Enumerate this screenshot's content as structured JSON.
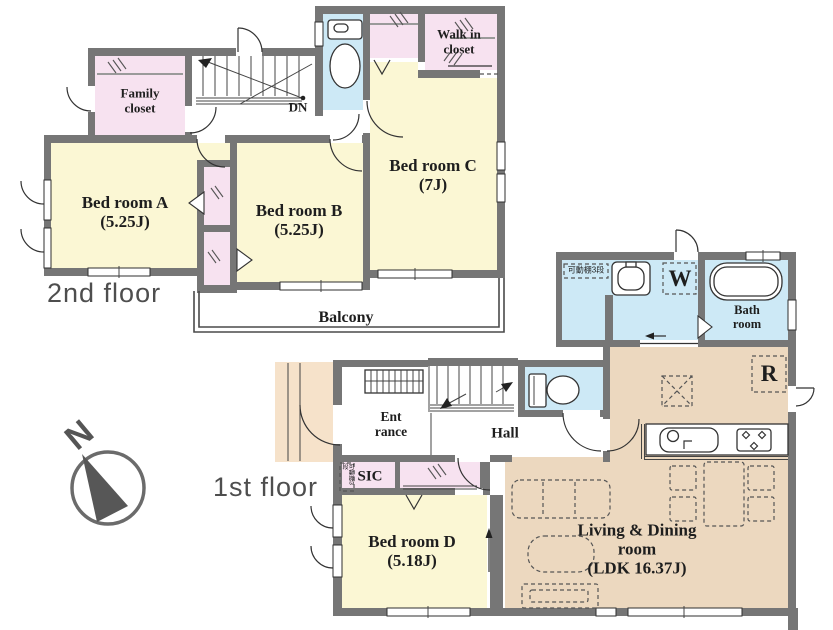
{
  "title": "2-story house floor plan",
  "colors": {
    "wall": "#767676",
    "bedroom": "#fbf7d4",
    "closet": "#f7e2f0",
    "wet": "#cde9f6",
    "ldk": "#ecd8bf",
    "porch": "#f6e2ca"
  },
  "compass": {
    "label": "N"
  },
  "second_floor": {
    "floor_label": "2nd floor",
    "family_closet_1": "Family",
    "family_closet_2": "closet",
    "bedroom_a_name": "Bed room A",
    "bedroom_a_size": "(5.25J)",
    "bedroom_b_name": "Bed room B",
    "bedroom_b_size": "(5.25J)",
    "bedroom_c_name": "Bed room C",
    "bedroom_c_size": "(7J)",
    "wic_1": "Walk in",
    "wic_2": "closet",
    "stairs_label": "DN",
    "balcony_label": "Balcony"
  },
  "first_floor": {
    "floor_label": "1st floor",
    "entrance_1": "Ent",
    "entrance_2": "rance",
    "hall_label": "Hall",
    "sic_label": "SIC",
    "sic_shelf_note": "可動棚3段",
    "wash_shelf_note": "可動棚3段",
    "washer_label": "W",
    "fridge_label": "R",
    "bath_1": "Bath",
    "bath_2": "room",
    "bedroom_d_name": "Bed room D",
    "bedroom_d_size": "(5.18J)",
    "ldk_1": "Living & Dining",
    "ldk_2": "room",
    "ldk_3": "(LDK 16.37J)"
  }
}
